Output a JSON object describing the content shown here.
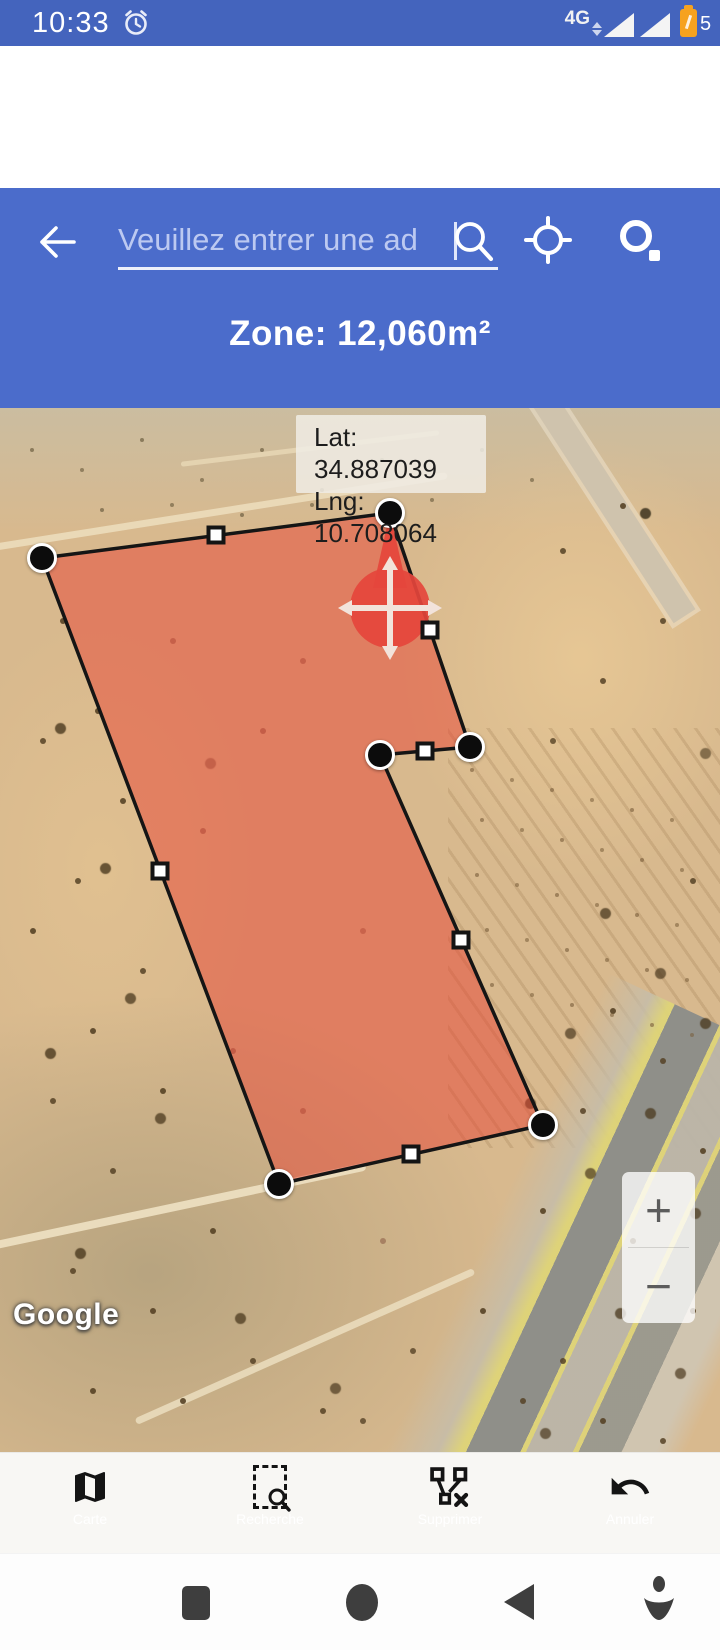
{
  "status_bar": {
    "time": "10:33",
    "network_label": "4G",
    "battery_percent": "5",
    "colors": {
      "bg": "#4464BD",
      "battery": "#F6A21E"
    }
  },
  "header": {
    "bg": "#4B6CCB",
    "search": {
      "placeholder": "Veuillez entrer une ad"
    },
    "zone_label": "Zone: 12,060m²"
  },
  "map": {
    "tooltip": {
      "lat": "Lat: 34.887039",
      "lng": "Lng: 10.708064"
    },
    "attribution": "Google",
    "zoom_in": "+",
    "zoom_out": "−",
    "polygon": {
      "fill": "rgba(231,63,48,0.48)",
      "stroke": "#151515",
      "vertices": [
        [
          42,
          150
        ],
        [
          390,
          105
        ],
        [
          470,
          339
        ],
        [
          380,
          347
        ],
        [
          543,
          717
        ],
        [
          279,
          776
        ]
      ],
      "midpoints": [
        [
          216,
          127
        ],
        [
          430,
          222
        ],
        [
          425,
          343
        ],
        [
          461,
          532
        ],
        [
          411,
          746
        ],
        [
          160,
          463
        ]
      ],
      "marker": {
        "x": 390,
        "y": 200,
        "tip_y": 105,
        "color": "#E5453C",
        "cross_color": "#F2E3DB"
      }
    }
  },
  "toolbar": {
    "items": [
      {
        "label": "Carte"
      },
      {
        "label": "Recherche"
      },
      {
        "label": "Supprimer"
      },
      {
        "label": "Annuler"
      }
    ]
  }
}
